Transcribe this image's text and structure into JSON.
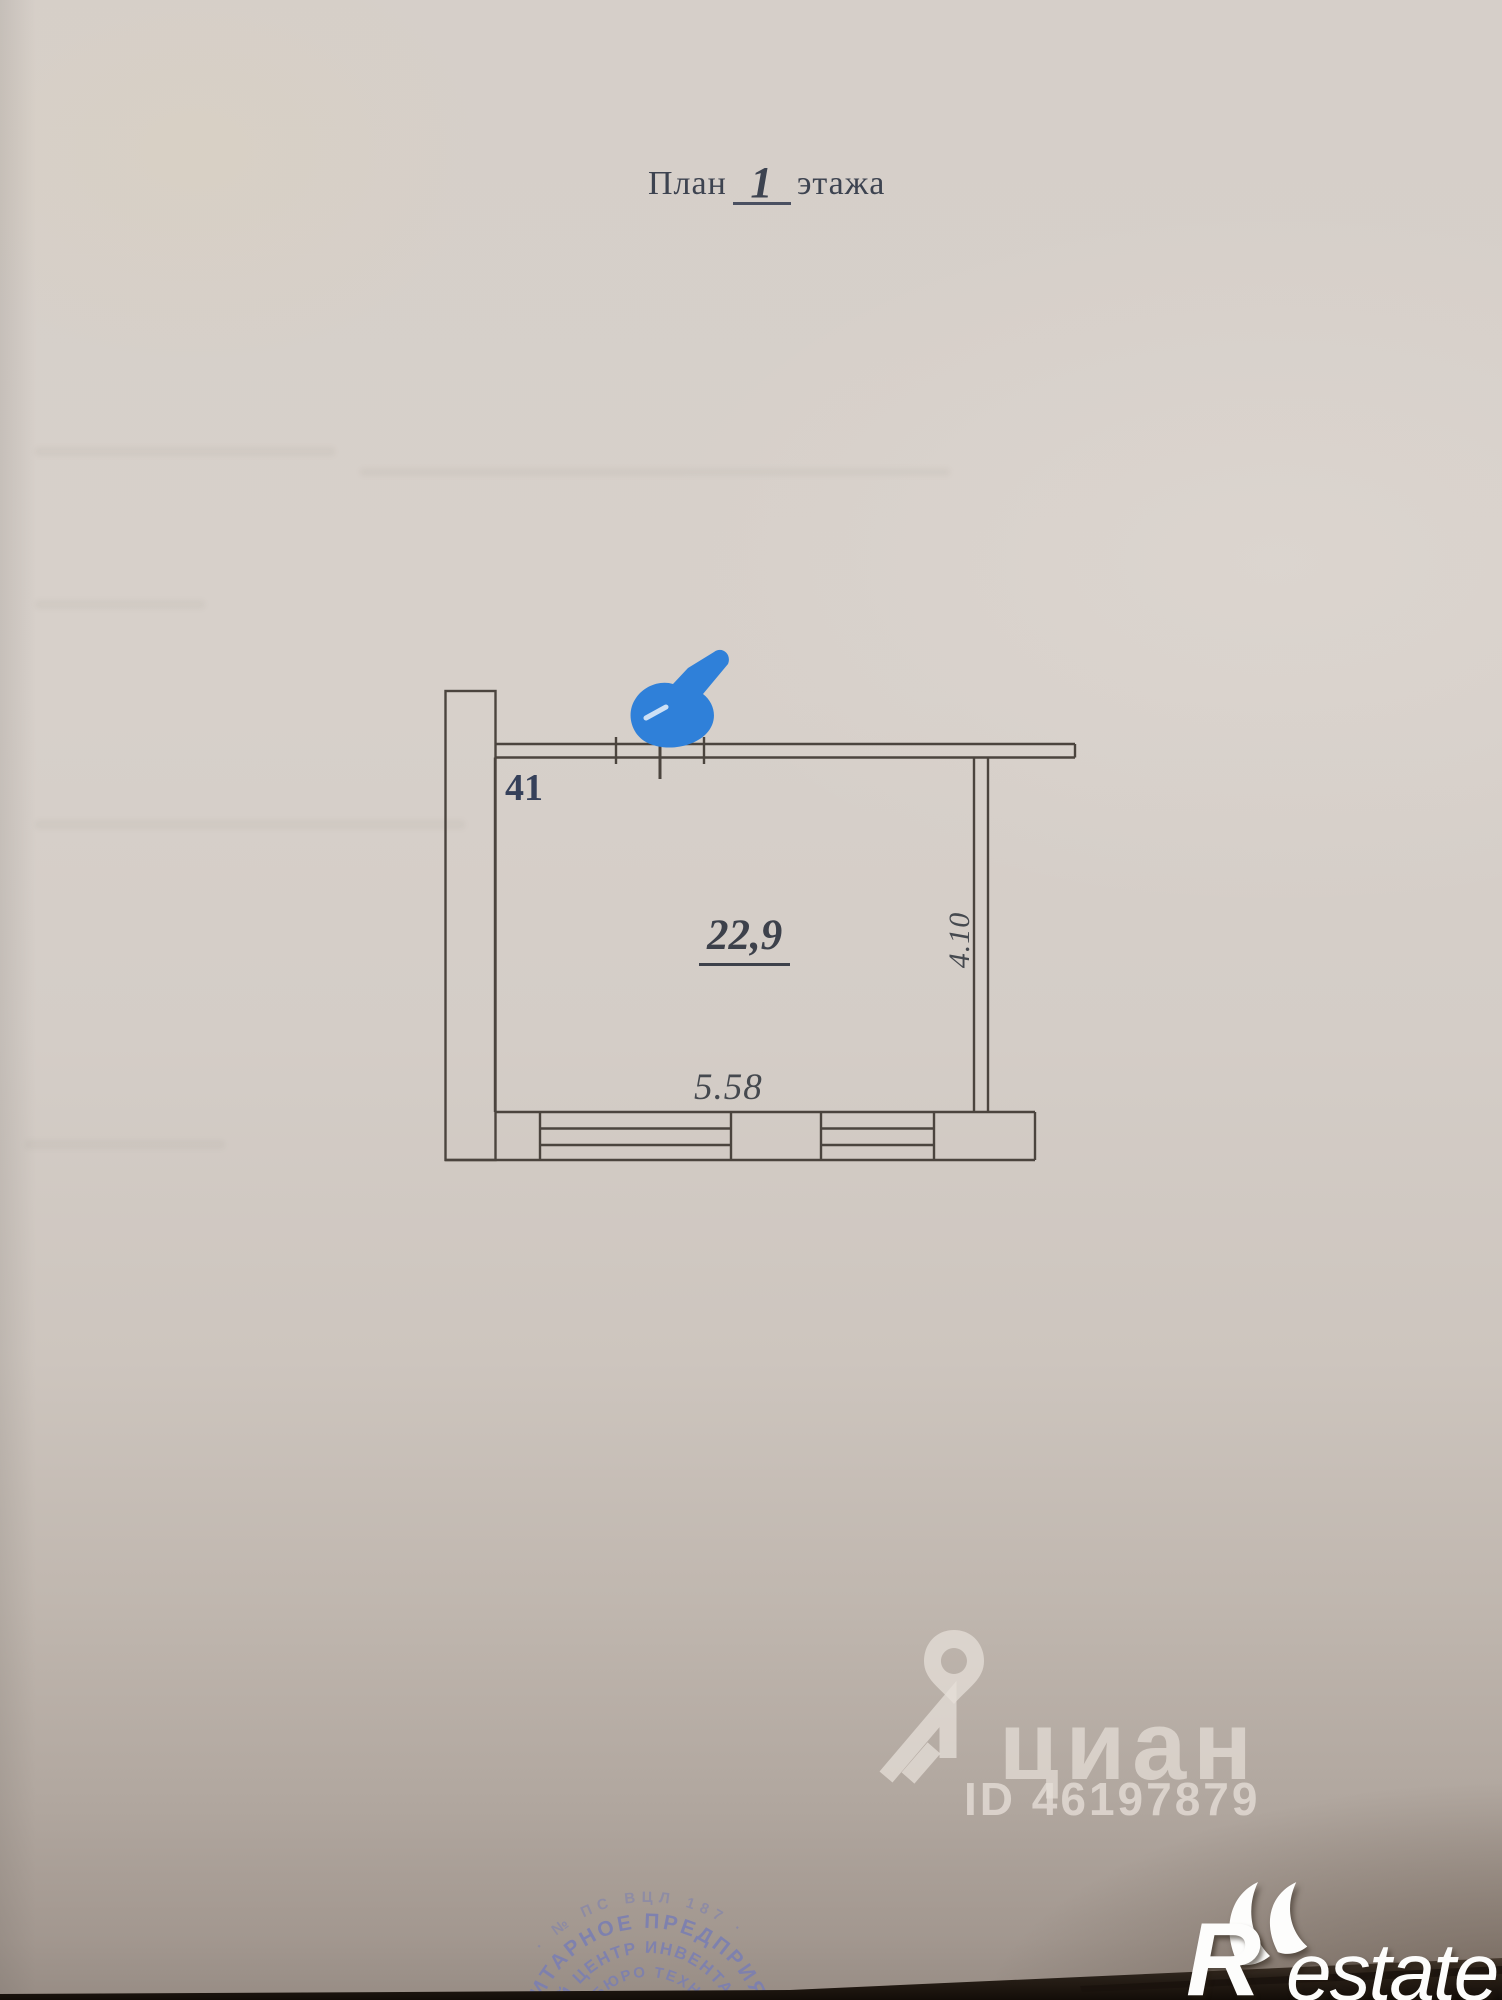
{
  "title": {
    "prefix": "План",
    "floor": "1",
    "suffix": "этажа"
  },
  "plan": {
    "room_number": "41",
    "area": "22,9",
    "width": "5.58",
    "depth": "4.10"
  },
  "watermark": {
    "brand": "циан",
    "listing_id": "ID 46197879"
  },
  "stamp": {
    "ring_outer": "· № ПС ВЦЛ 187 ·",
    "ring1": "УНИТАРНОЕ ПРЕДПРИЯТ",
    "ring2": "ЧНЫЙ ЦЕНТР ИНВЕНТАРИЗ",
    "ring3": "ОЕ БЮРО ТЕХНИЧ",
    "ring4": "ИЗАЦИЯ"
  },
  "logo": {
    "initial": "R",
    "rest": "estate"
  },
  "colors": {
    "paper": "#d6cfc9",
    "plan_line": "#4b443e",
    "marker_blue": "#2f80d9",
    "stamp_blue": "#7b7fb2",
    "ink_navy": "#35405a"
  }
}
